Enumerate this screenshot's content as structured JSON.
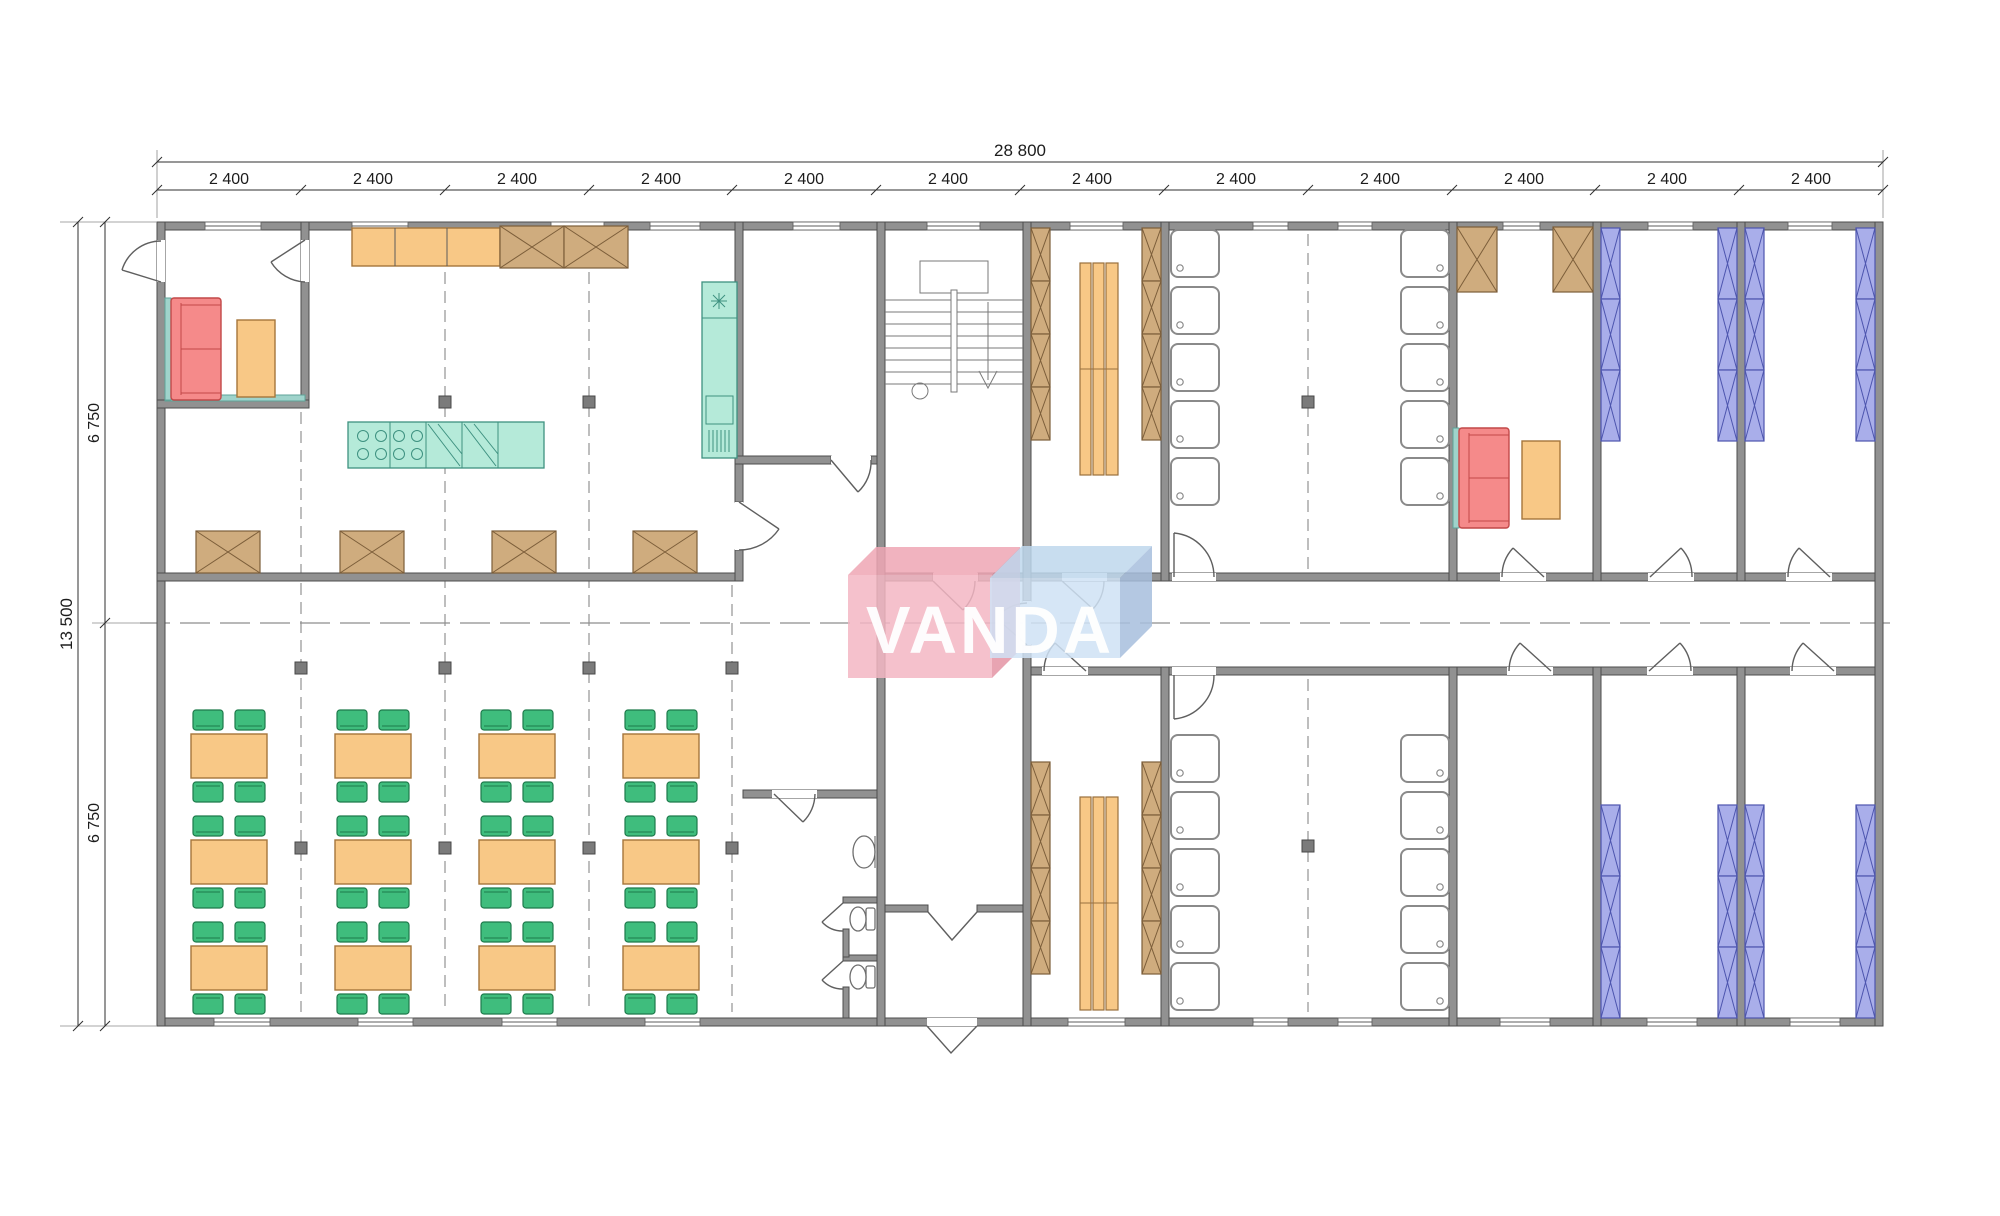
{
  "dimensions": {
    "overall_width": "28 800",
    "overall_height": "13 500",
    "module_width_labels": [
      "2 400",
      "2 400",
      "2 400",
      "2 400",
      "2 400",
      "2 400",
      "2 400",
      "2 400",
      "2 400",
      "2 400",
      "2 400",
      "2 400"
    ],
    "half_height_labels": [
      "6 750",
      "6 750"
    ]
  },
  "watermark": {
    "text": "VANDA",
    "pink_block_color": "#f3b6c3",
    "blue_block_color": "#cfe2f4",
    "text_color": "#ffffff"
  },
  "palette": {
    "wall_gray": "#919191",
    "wood_cabinet": "#cfac7e",
    "counter_orange": "#f8c886",
    "chair_green": "#3fbd7d",
    "kitchen_teal": "#b5ead9",
    "sofa_red": "#f58a8a",
    "bunk_purple": "#a9aeea",
    "column_gray": "#7b7b7b"
  }
}
